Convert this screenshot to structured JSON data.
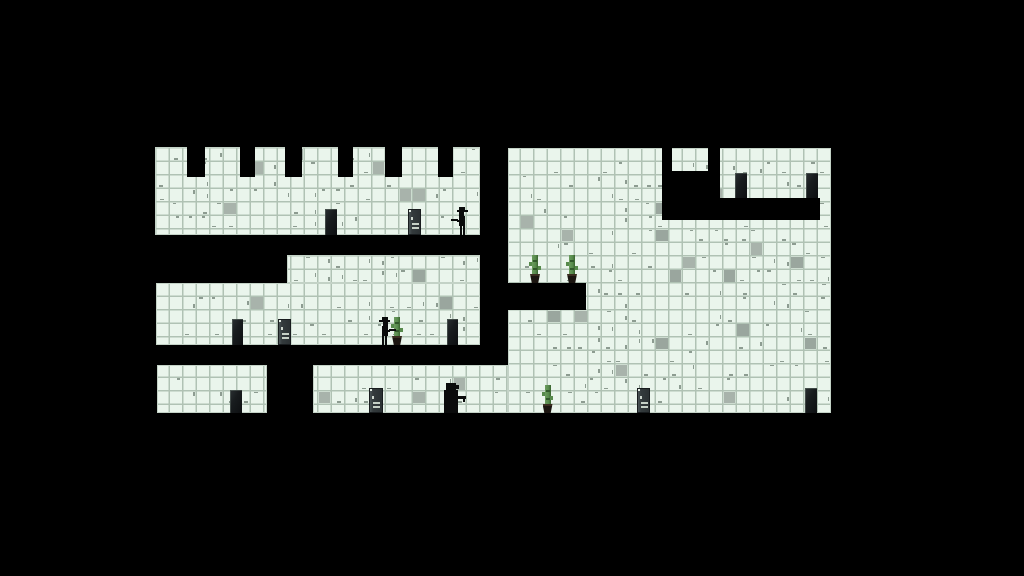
{
  "meta": {
    "scene": "monochrome tiled platformer level on black background",
    "background_color": "#000000"
  },
  "palette": {
    "tile_fill": "#eaf5ec",
    "tile_grout": "#b0c2b4",
    "gray_tile_a": "#9aa69e",
    "gray_tile_b": "#a8b3ab",
    "tick_color": "rgba(48,68,54,0.5)",
    "door_dark": "#14171a",
    "door_sign_body": "#343b3d",
    "door_sign_marks": "#c6d0c6",
    "cactus_green": "#578a4c",
    "cactus_pot": "#1b1510",
    "sprite_black": "#0a0b0b"
  },
  "grid": {
    "origin_x": 155,
    "origin_y": 147,
    "tile_size": 13.5
  },
  "decor": {
    "gray_tile_ratio": 0.05,
    "tick_ratio": 0.42
  },
  "tile_regions": [
    {
      "name": "top-left-band",
      "x": 155,
      "y": 147,
      "w": 325,
      "h": 88
    },
    {
      "name": "mid-band-upper",
      "x": 287,
      "y": 255,
      "w": 193,
      "h": 28
    },
    {
      "name": "mid-band-lower",
      "x": 156,
      "y": 283,
      "w": 324,
      "h": 62
    },
    {
      "name": "right-room",
      "x": 508,
      "y": 148,
      "w": 323,
      "h": 265
    },
    {
      "name": "bottom-left-block",
      "x": 157,
      "y": 365,
      "w": 110,
      "h": 48
    },
    {
      "name": "bottom-mid-block",
      "x": 313,
      "y": 365,
      "w": 195,
      "h": 48
    }
  ],
  "black_overlays": [
    {
      "name": "crenel-notch-1",
      "x": 187,
      "y": 147,
      "w": 18,
      "h": 30
    },
    {
      "name": "crenel-notch-2",
      "x": 240,
      "y": 147,
      "w": 15,
      "h": 30
    },
    {
      "name": "crenel-notch-3",
      "x": 285,
      "y": 147,
      "w": 17,
      "h": 30
    },
    {
      "name": "crenel-notch-4",
      "x": 338,
      "y": 147,
      "w": 15,
      "h": 30
    },
    {
      "name": "crenel-notch-5",
      "x": 385,
      "y": 147,
      "w": 17,
      "h": 30
    },
    {
      "name": "crenel-notch-6",
      "x": 438,
      "y": 147,
      "w": 15,
      "h": 30
    },
    {
      "name": "upper-right-notch-a",
      "x": 662,
      "y": 148,
      "w": 10,
      "h": 25
    },
    {
      "name": "upper-right-notch-b",
      "x": 708,
      "y": 148,
      "w": 12,
      "h": 25
    },
    {
      "name": "upper-right-void",
      "x": 662,
      "y": 171,
      "w": 58,
      "h": 49
    },
    {
      "name": "upper-right-shelf",
      "x": 708,
      "y": 198,
      "w": 112,
      "h": 22
    },
    {
      "name": "cactus-platform",
      "x": 506,
      "y": 283,
      "w": 80,
      "h": 27
    }
  ],
  "doors": {
    "dark": [
      {
        "name": "dark-door-top-band",
        "x": 325,
        "y": 209,
        "w": 12,
        "h": 26
      },
      {
        "name": "dark-door-mid-left",
        "x": 232,
        "y": 319,
        "w": 11,
        "h": 26
      },
      {
        "name": "dark-door-mid-right",
        "x": 447,
        "y": 319,
        "w": 11,
        "h": 26
      },
      {
        "name": "dark-door-bottom-left",
        "x": 230,
        "y": 390,
        "w": 12,
        "h": 23
      },
      {
        "name": "dark-door-bottom-right",
        "x": 805,
        "y": 388,
        "w": 12,
        "h": 25
      },
      {
        "name": "alcove-door-a",
        "x": 735,
        "y": 173,
        "w": 12,
        "h": 25
      },
      {
        "name": "alcove-door-b",
        "x": 806,
        "y": 173,
        "w": 12,
        "h": 25
      }
    ],
    "sign": [
      {
        "name": "sign-door-top-band",
        "x": 408,
        "y": 209,
        "w": 13,
        "h": 26
      },
      {
        "name": "sign-door-mid-band",
        "x": 278,
        "y": 319,
        "w": 13,
        "h": 26
      },
      {
        "name": "sign-door-bottom-a",
        "x": 369,
        "y": 388,
        "w": 14,
        "h": 25
      },
      {
        "name": "sign-door-bottom-b",
        "x": 637,
        "y": 388,
        "w": 13,
        "h": 25
      }
    ]
  },
  "cacti": [
    {
      "name": "cactus-platform-left",
      "x": 529,
      "y": 255,
      "w": 12,
      "h": 28
    },
    {
      "name": "cactus-platform-right",
      "x": 566,
      "y": 255,
      "w": 12,
      "h": 28
    },
    {
      "name": "cactus-mid-band",
      "x": 391,
      "y": 317,
      "w": 12,
      "h": 28
    },
    {
      "name": "cactus-bottom-band",
      "x": 542,
      "y": 385,
      "w": 11,
      "h": 28
    }
  ],
  "characters": [
    {
      "type": "cowboy",
      "name": "gunman-top-band",
      "x": 456,
      "y": 207,
      "w": 14,
      "h": 28,
      "facing": "left"
    },
    {
      "type": "cowboy",
      "name": "gunman-mid-band",
      "x": 377,
      "y": 317,
      "w": 14,
      "h": 28,
      "facing": "right"
    },
    {
      "type": "bear",
      "name": "gunman-bottom-band",
      "x": 444,
      "y": 383,
      "w": 21,
      "h": 30,
      "facing": "right"
    }
  ]
}
